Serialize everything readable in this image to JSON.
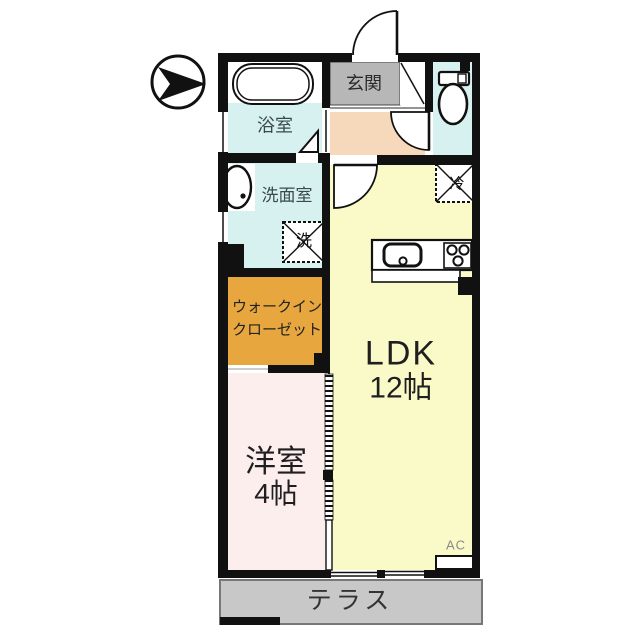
{
  "plan": {
    "rooms": {
      "entrance": {
        "label": "玄関"
      },
      "bathroom": {
        "label": "浴室"
      },
      "washroom": {
        "label": "洗面室"
      },
      "washer_box": {
        "label": "洗"
      },
      "refrigerator_box": {
        "label": "冷"
      },
      "walk_in_closet": {
        "line1": "ウォークイン",
        "line2": "クローゼット"
      },
      "ldk": {
        "name": "LDK",
        "size": "12帖"
      },
      "western_room": {
        "name": "洋室",
        "size": "4帖"
      },
      "air_conditioner": {
        "label": "AC"
      },
      "terrace": {
        "label": "テラス"
      }
    },
    "colors": {
      "water_rooms_cyan": "#d7f1f0",
      "hall_peach": "#f6d9bb",
      "ldk_yellow": "#fafac8",
      "western_room_pink": "#fdeeee",
      "closet_orange": "#e8a63e",
      "entrance_gray": "#b7b7b7",
      "terrace_gray": "#c8c8c8",
      "wall_black": "#111111"
    }
  }
}
